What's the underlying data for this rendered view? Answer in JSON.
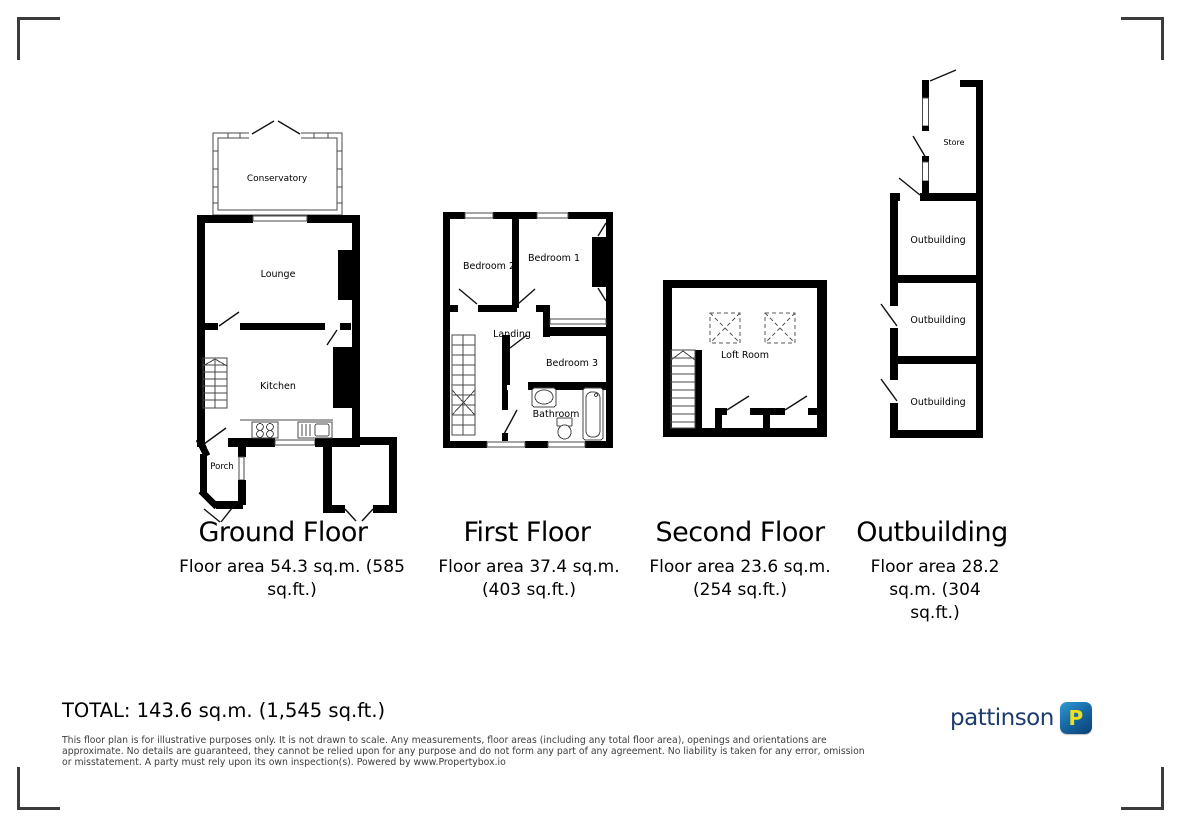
{
  "page": {
    "background": "#ffffff",
    "wall_color": "#000000",
    "corner_mark_color": "#3b3b3b"
  },
  "plans": [
    {
      "title": "Ground Floor",
      "caption_lines": [
        "Floor area 54.3 sq.m. (585",
        "sq.ft.)"
      ],
      "rooms": [
        "Conservatory",
        "Lounge",
        "Kitchen",
        "Porch"
      ]
    },
    {
      "title": "First Floor",
      "caption_lines": [
        "Floor area 37.4 sq.m.",
        "(403 sq.ft.)"
      ],
      "rooms": [
        "Bedroom 2",
        "Bedroom 1",
        "Landing",
        "Bedroom 3",
        "Bathroom"
      ]
    },
    {
      "title": "Second Floor",
      "caption_lines": [
        "Floor area 23.6 sq.m.",
        "(254 sq.ft.)"
      ],
      "rooms": [
        "Loft Room"
      ]
    },
    {
      "title": "Outbuilding",
      "caption_lines": [
        "Floor area 28.2",
        "sq.m. (304",
        "sq.ft.)"
      ],
      "rooms": [
        "Store",
        "Outbuilding",
        "Outbuilding",
        "Outbuilding"
      ]
    }
  ],
  "footer": {
    "total": "TOTAL: 143.6 sq.m. (1,545 sq.ft.)",
    "disclaimer_lines": [
      "This floor plan is for illustrative purposes only. It is not drawn to scale. Any measurements, floor areas (including any total floor area), openings and orientations are",
      "approximate. No details are guaranteed, they cannot be relied upon for any purpose and do not form any part of any agreement. No liability is taken for any error, omission",
      "or misstatement. A party must rely upon its own inspection(s). Powered by www.Propertybox.io"
    ]
  },
  "brand": {
    "name": "pattinson",
    "monogram": "P",
    "text_color": "#1d3c6e",
    "icon_bg_top": "#2f9ad2",
    "icon_bg_bottom": "#0d3f75",
    "monogram_color": "#eedf1f"
  }
}
